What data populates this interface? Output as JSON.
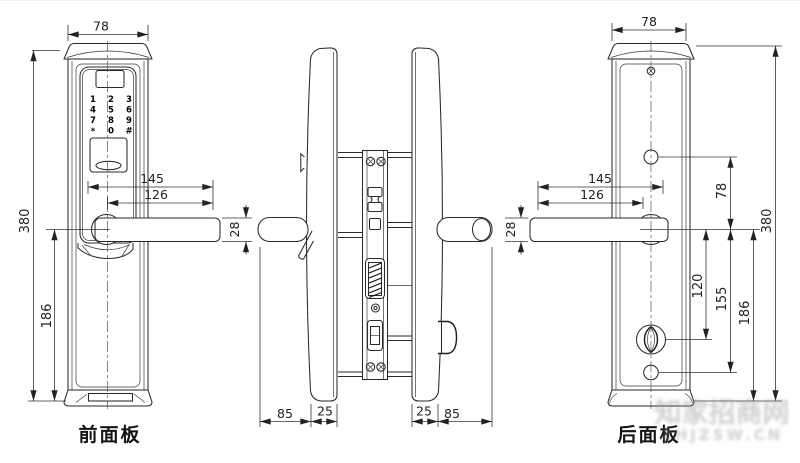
{
  "labels": {
    "front_panel": "前面板",
    "back_panel": "后面板"
  },
  "keypad_keys": [
    "1",
    "2",
    "3",
    "4",
    "5",
    "6",
    "7",
    "8",
    "9",
    "*",
    "0",
    "#"
  ],
  "dims": {
    "front_width": "78",
    "front_height": "380",
    "front_handle_to_bottom": "186",
    "front_reach_145": "145",
    "front_reach_126": "126",
    "front_handle_thickness": "28",
    "side_left_85": "85",
    "side_left_25": "25",
    "side_right_25": "25",
    "side_right_85": "85",
    "back_width": "78",
    "back_height": "380",
    "back_hole_to_handle": "78",
    "back_reach_145": "145",
    "back_reach_126": "126",
    "back_handle_thickness": "28",
    "back_handle_to_knob": "120",
    "back_handle_to_hole": "155",
    "back_handle_to_bottom": "186"
  },
  "watermark": {
    "line1": "知家招商网",
    "line2": "ZHJZSW.CN"
  },
  "colors": {
    "line": "#2a2a2a",
    "dim": "#333333",
    "background": "#ffffff"
  }
}
